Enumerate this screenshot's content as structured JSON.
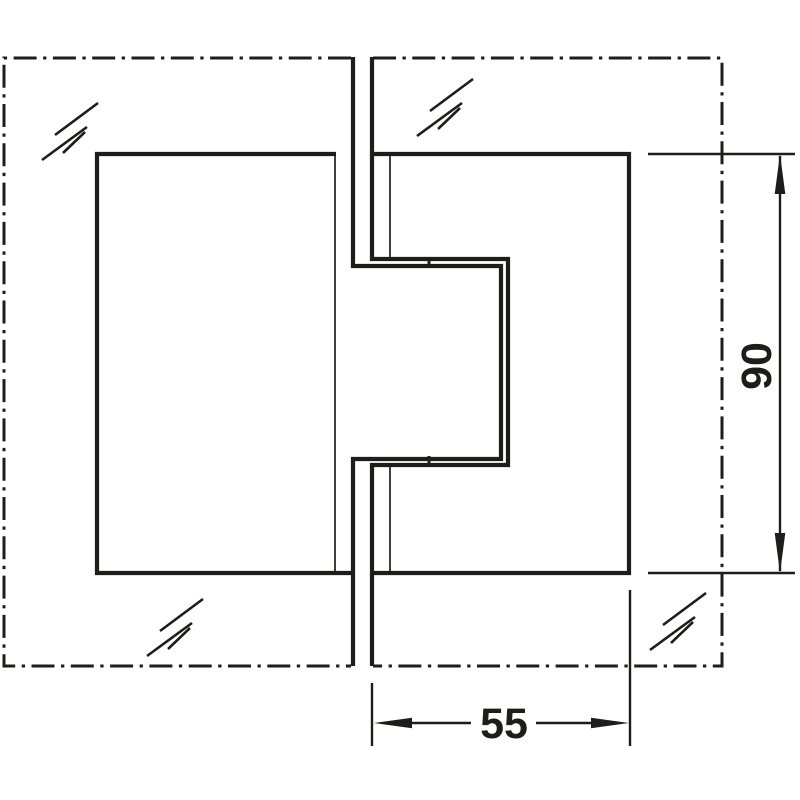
{
  "diagram": {
    "background_color": "#ffffff",
    "line_color": "#1d1d1b",
    "dimensions": {
      "height": {
        "label": "90",
        "orientation": "vertical"
      },
      "width": {
        "label": "55",
        "orientation": "horizontal"
      }
    },
    "symbols": {
      "glass_hatch": "glass-hatch-icon",
      "panel_outline": "dash-dot centerline rectangle"
    }
  }
}
